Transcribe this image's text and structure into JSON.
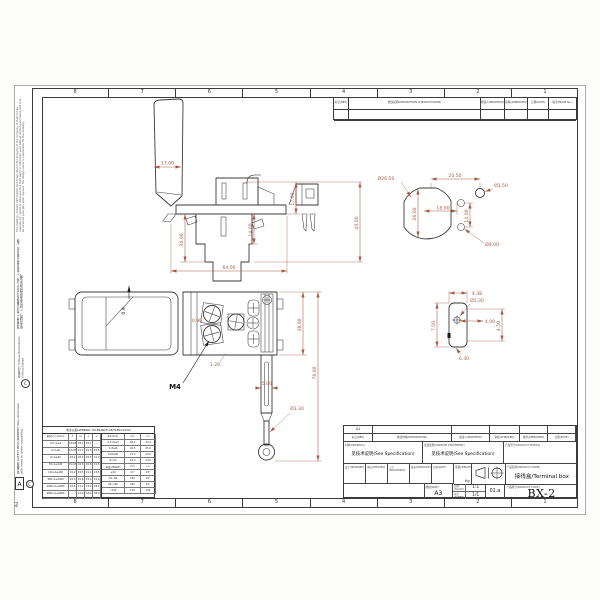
{
  "colors": {
    "line": "#3a3a3a",
    "dim": "#a85a42",
    "paper": "#ffffff"
  },
  "grid": {
    "top": [
      "8",
      "7",
      "6",
      "5",
      "4",
      "3",
      "2",
      "1"
    ],
    "bottom": [
      "8",
      "7",
      "6",
      "5",
      "4",
      "3",
      "2",
      "1"
    ],
    "row_letter": "A",
    "sheet_size": "A3"
  },
  "margin": {
    "disclaimer": "This drawing contains information and image that is the property of the company. It shall not be reproduced, copied or disclosed to a third party or otherwise used without written permission and is to be returned promptly upon request. The design owner is responsible for the drawing.",
    "notes_cn": "技术要求: 1.未注公差按GB/T1804-m级。 2.制品表面不得有毛刺、裂纹、缩水等缺陷。 3.材料及表面处理见技术说明。",
    "critical": "关键尺寸 Critical dimensions Critical Dates",
    "safety": "安全要求 SAFETY REQUIREMENT (Key dimension with need to under capability)",
    "mark_symbol": "C"
  },
  "rev_table": {
    "headers": [
      "标记(REV)",
      "修改说明(DESCRIPTION of MODIFICATION)",
      "修改人(MODIFIED)",
      "审核(APPROVED)",
      "日期(DATE)",
      "版次(ISSUE No.)"
    ]
  },
  "views": {
    "side": {
      "handle_w": "17.00",
      "body_h": "36.00",
      "mid_h": "14.00",
      "step_h": "17.00",
      "total_h": "43.00",
      "width": "64.00"
    },
    "front": {
      "tilt": "0.9",
      "gap": "0.90",
      "pitch": "1.20",
      "screw": "M4",
      "height": "38.00",
      "total_h": "76.00",
      "pin_w": "5.00",
      "pin_d": "Ø3.30"
    },
    "circular": {
      "body_d": "Ø26.50",
      "body_h": "26.00",
      "span": "20.50",
      "hole_s": "Ø3.50",
      "off_x": "18.00",
      "off_y": "14.00",
      "hole_l": "Ø4.00"
    },
    "detail": {
      "w": "4.38",
      "hole": "Ø1.30",
      "off": "4.00",
      "h": "7.50",
      "h2": "4.50",
      "foot": "6.30"
    }
  },
  "tolerance": {
    "title": "未注公差(GENERAL TOLERANCE GB/T1804-2000)",
    "dim_header": "基本尺寸 A(mm)",
    "classes": [
      "f",
      "m",
      "c",
      "v"
    ],
    "linear": [
      [
        "0.5<A≤3",
        "±0.05",
        "±0.1",
        "±0.2",
        "—"
      ],
      [
        "3<A≤6",
        "±0.05",
        "±0.1",
        "±0.3",
        "±0.5"
      ],
      [
        "6<A≤30",
        "±0.1",
        "±0.2",
        "±0.5",
        "±1.0"
      ],
      [
        "30<A≤120",
        "±0.15",
        "±0.3",
        "±0.8",
        "±1.5"
      ],
      [
        "120<A≤400",
        "±0.2",
        "±0.5",
        "±1.2",
        "±2.5"
      ],
      [
        "400<A≤1000",
        "±0.3",
        "±0.8",
        "±2.0",
        "±4.0"
      ],
      [
        "1000<A≤2000",
        "±0.5",
        "±1.2",
        "±3.0",
        "±6.0"
      ],
      [
        "2000<A≤4000",
        "—",
        "±2.0",
        "±4.0",
        "±8.0"
      ]
    ],
    "rc_header": [
      "R/C(mm)",
      "f-m",
      "c-v"
    ],
    "radius": [
      [
        "0.5<R≤3",
        "±0.2",
        "±0.4"
      ],
      [
        "3<R≤6",
        "±0.5",
        "±1.0"
      ],
      [
        "6<R≤30",
        "±1.0",
        "±2.0"
      ],
      [
        "R>30",
        "±2.0",
        "±4.0"
      ]
    ],
    "angle_header": [
      "角度(ANGLE)",
      "f-m",
      "c-v"
    ],
    "angle": [
      [
        "≤10",
        "±1°",
        "±3°"
      ],
      [
        "10~50",
        "±30′",
        "±2°"
      ],
      [
        "50~120",
        "±20′",
        "±1°"
      ],
      [
        ">120",
        "±10′",
        "±30′"
      ]
    ]
  },
  "title_block": {
    "r1": [
      "01",
      "",
      "",
      "",
      "",
      ""
    ],
    "r2": [
      "标记(REV)",
      "修改内容(DESCRIPTION)",
      "更改人(MODIFIED)",
      "审核(CHECKED)",
      "批准(APPROVED)",
      "日期(DATE)"
    ],
    "material_label": "材料(MATERIAL)",
    "material_value": "见技术说明(See Specification)",
    "surface_label": "表面处理(SURFACE TREATMENT)",
    "surface_value": "见技术说明(See Specification)",
    "model_label": "产品型号(PRODUCT MODEL)",
    "model_value": "",
    "sign_cells": [
      "设计(DESIGNED)",
      "审核(CHECKED)",
      "工艺(PROCESSED)",
      "批准(APPROVED)",
      "日期(DATE)"
    ],
    "weight_label": "重量(WEIGHT)",
    "weight_unit": "Kg",
    "size_label": "图幅(SIZE)",
    "size_value": "A3",
    "scale_label": "比例(SCALE)",
    "scale_value": "1:1",
    "sheet_label": "张次(SHEET)",
    "sheet_value": "1/1",
    "version_value": "01.a",
    "name_label": "产品名称(PRODUCT NAME)",
    "name_value": "接线盒/Terminal box",
    "code_label": "产品图号(PRODUCT CODE)",
    "code_value": "BX-2"
  }
}
